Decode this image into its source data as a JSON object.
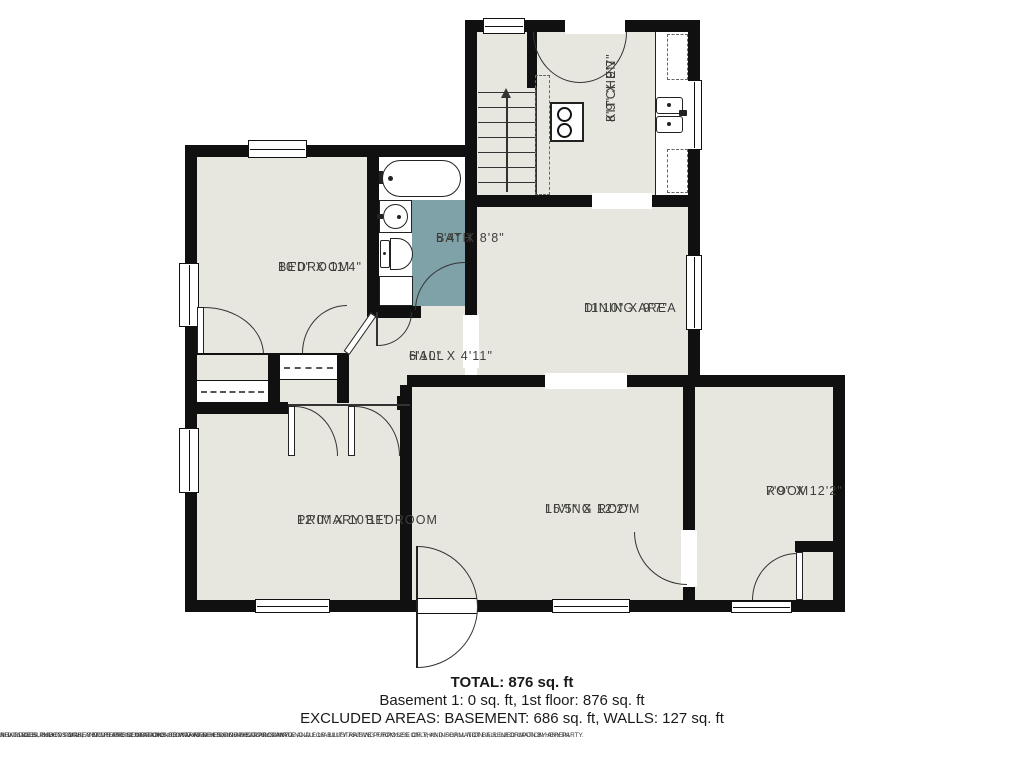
{
  "plan": {
    "rooms": {
      "kitchen": {
        "name": "KITCHEN",
        "dims": "8'9\" X 9'7\""
      },
      "bath": {
        "name": "BATH",
        "dims": "5'4\" X 8'8\""
      },
      "bedroom": {
        "name": "BEDROOM",
        "dims": "10'0\" X 11'4\""
      },
      "dining": {
        "name": "DINING AREA",
        "dims": "11'10\" X 9'7\""
      },
      "hall": {
        "name": "HALL",
        "dims": "6'10\" X 4'11\""
      },
      "primary": {
        "name": "PRIMARY BEDROOM",
        "dims": "12'0\" X 10'11\""
      },
      "living": {
        "name": "LIVING ROOM",
        "dims": "15'5\" X 12'2\""
      },
      "room": {
        "name": "ROOM",
        "dims": "7'9\" X 12'2\""
      }
    },
    "colors": {
      "wall": "#101010",
      "floor": "#e8e7df",
      "bath_floor": "#7fa2a8",
      "background": "#ffffff"
    }
  },
  "summary": {
    "total": "TOTAL: 876 sq. ft",
    "floors": "Basement 1: 0 sq. ft, 1st floor: 876 sq. ft",
    "excluded": "EXCLUDED AREAS: BASEMENT: 686 sq. ft, WALLS: 127 sq. ft"
  },
  "disclaimer": {
    "line1": "ALL IMAGES, DIMENSIONS, AND OTHER INFORMATION CONTAINED HEREIN ARE APPROXIMATE AND FOR ILLUSTRATIVE PURPOSES ONLY, AND SHALL NOT BE RELIED UPON BY ANY PARTY.",
    "line2": "NEXT DOOR PHOTOS MAKES NO REPRESENTATIONS OR WARRANTIES, AND DISCLAIMS ANY AND ALL LIABILITY ARISING FROM USE OF THIS INFORMATION. ALL INFORMATION HEREIN",
    "line3": "SHALL BE SUBJECT TO THE TERMS AND CONDITIONS FOUND AT NEXTDOORPHOTOS.COM/TC."
  }
}
